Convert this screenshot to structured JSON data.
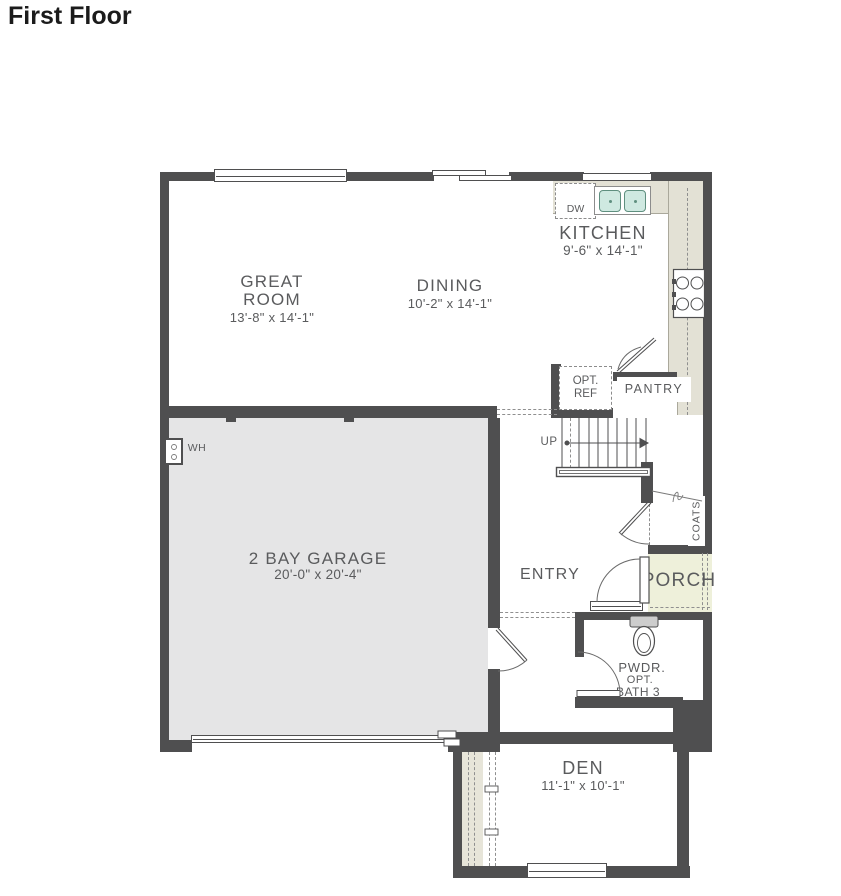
{
  "title": "First Floor",
  "colors": {
    "wall": "#4f4f50",
    "counter": "#e3e1d5",
    "garage_floor": "#e5e5e6",
    "porch_floor": "#eef0da",
    "fixture_teal": "#cfe9e1",
    "label_text": "#5a5b5d"
  },
  "rooms": {
    "great_room": {
      "line1": "GREAT",
      "line2": "ROOM",
      "dims": "13'-8\" x 14'-1\""
    },
    "dining": {
      "name": "DINING",
      "dims": "10'-2\" x 14'-1\""
    },
    "kitchen": {
      "name": "KITCHEN",
      "dims": "9'-6\" x 14'-1\""
    },
    "garage": {
      "name": "2 BAY GARAGE",
      "dims": "20'-0\" x 20'-4\""
    },
    "den": {
      "name": "DEN",
      "dims": "11'-1\" x 10'-1\""
    },
    "entry": {
      "name": "ENTRY"
    },
    "porch": {
      "name": "PORCH"
    },
    "pantry": {
      "name": "PANTRY"
    },
    "coats": {
      "name": "COATS"
    },
    "powder": {
      "line1": "PWDR.",
      "line2": "OPT.",
      "line3": "BATH 3"
    }
  },
  "fixtures": {
    "dishwasher": "DW",
    "opt_ref_line1": "OPT.",
    "opt_ref_line2": "REF",
    "water_heater": "WH",
    "stairs_direction": "UP"
  }
}
